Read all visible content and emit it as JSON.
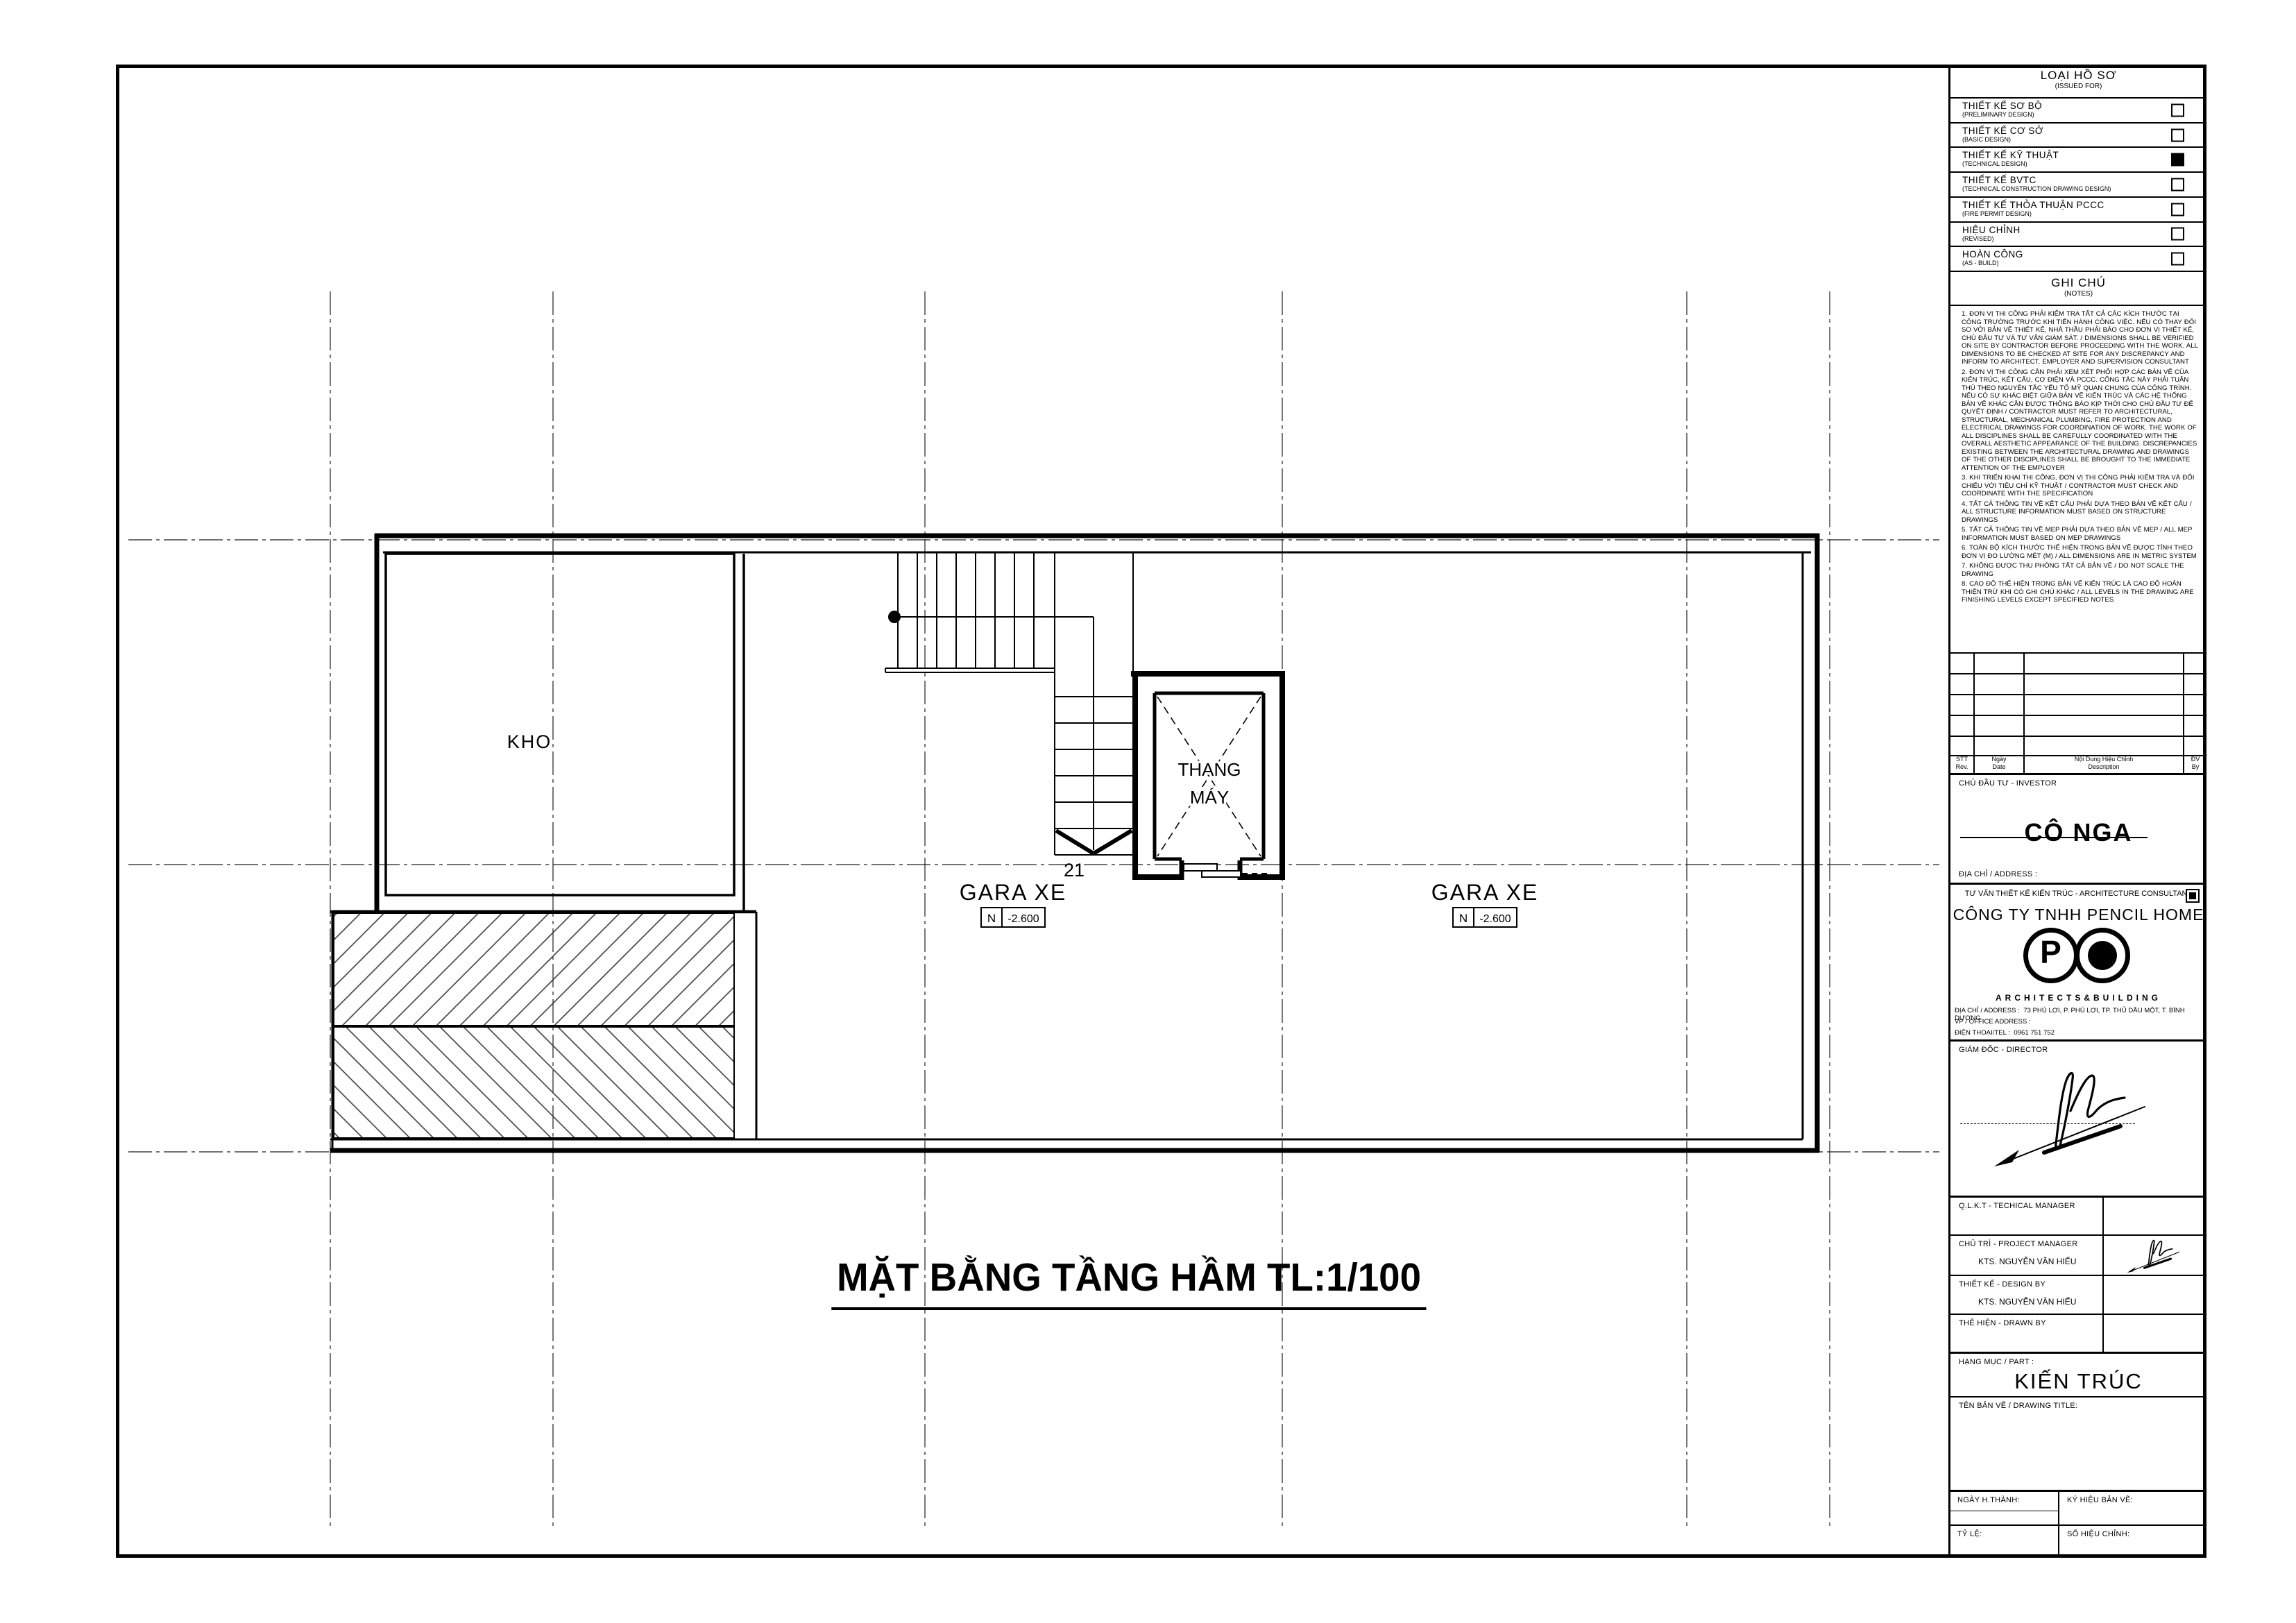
{
  "sheet": {
    "main_title": "MẶT BẰNG TẦNG HẦM  TL:1/100"
  },
  "issued_for": {
    "title": "LOẠI HỒ SƠ",
    "subtitle": "(ISSUED FOR)",
    "items": [
      {
        "vi": "THIẾT KẾ SƠ BỘ",
        "en": "(PRELIMINARY DESIGN)",
        "checked": false
      },
      {
        "vi": "THIẾT KẾ CƠ SỞ",
        "en": "(BASIC DESIGN)",
        "checked": false
      },
      {
        "vi": "THIẾT KẾ KỸ THUẬT",
        "en": "(TECHNICAL DESIGN)",
        "checked": true
      },
      {
        "vi": "THIẾT KẾ BVTC",
        "en": "(TECHNICAL CONSTRUCTION DRAWING DESIGN)",
        "checked": false
      },
      {
        "vi": "THIẾT KẾ THỎA THUẬN PCCC",
        "en": "(FIRE PERMIT DESIGN)",
        "checked": false
      },
      {
        "vi": "HIỆU CHỈNH",
        "en": "(REVISED)",
        "checked": false
      },
      {
        "vi": "HOÀN CÔNG",
        "en": "(AS - BUILD)",
        "checked": false
      }
    ]
  },
  "notes": {
    "title": "GHI CHÚ",
    "subtitle": "(NOTES)",
    "items": [
      "1.    ĐƠN VỊ THI CÔNG PHẢI KIỂM TRA TẤT CẢ CÁC KÍCH THƯỚC TẠI CÔNG TRƯỜNG TRƯỚC KHI TIẾN HÀNH CÔNG VIỆC. NẾU CÓ THAY ĐỔI SO VỚI BẢN VẼ THIẾT KẾ, NHÀ THẦU PHẢI BÁO CHO ĐƠN VỊ THIẾT KẾ, CHỦ ĐẦU TƯ VÀ TƯ VẤN GIÁM SÁT. / DIMENSIONS SHALL BE VERIFIED ON SITE BY CONTRACTOR BEFORE PROCEEDING WITH THE WORK. ALL DIMENSIONS TO BE CHECKED AT SITE FOR ANY DISCREPANCY AND INFORM TO ARCHITECT, EMPLOYER AND SUPERVISION CONSULTANT",
      "2.    ĐƠN VỊ THI CÔNG CẦN PHẢI XEM XÉT PHỐI HỢP CÁC BẢN VẼ CỦA KIẾN TRÚC, KẾT CẤU, CƠ ĐIỆN VÀ PCCC. CÔNG TÁC NÀY PHẢI TUÂN THỦ THEO NGUYÊN TẮC YẾU TỐ MỸ QUAN CHUNG CỦA CÔNG TRÌNH. NẾU CÓ SỰ KHÁC BIỆT GIỮA BẢN VẼ KIẾN TRÚC VÀ CÁC HỆ THỐNG BẢN VẼ KHÁC CẦN ĐƯỢC THÔNG BÁO KỊP THỜI CHO CHỦ ĐẦU TƯ ĐỂ QUYẾT ĐỊNH / CONTRACTOR MUST REFER TO ARCHITECTURAL, STRUCTURAL, MECHANICAL PLUMBING, FIRE PROTECTION AND ELECTRICAL DRAWINGS FOR COORDINATION OF WORK. THE WORK OF ALL DISCIPLINES SHALL BE CAREFULLY COORDINATED WITH THE OVERALL AESTHETIC APPEARANCE OF THE BUILDING. DISCREPANCIES EXISTING BETWEEN THE ARCHITECTURAL DRAWING AND DRAWINGS OF THE OTHER DISCIPLINES SHALL BE BROUGHT TO THE IMMEDIATE ATTENTION OF THE EMPLOYER",
      "3.    KHI TRIỂN KHAI THI CÔNG, ĐƠN VỊ THI CÔNG PHẢI KIỂM TRA VÀ ĐỐI CHIẾU VỚI TIÊU CHÍ KỸ THUẬT / CONTRACTOR MUST CHECK AND COORDINATE WITH THE SPECIFICATION",
      "4.    TẤT CẢ THÔNG TIN VỀ KẾT CẤU PHẢI DỰA THEO BẢN VẼ KẾT CẤU / ALL STRUCTURE INFORMATION MUST BASED ON STRUCTURE DRAWINGS",
      "5.    TẤT CẢ THÔNG TIN VỀ MEP PHẢI DỰA THEO BẢN VẼ MEP / ALL MEP INFORMATION MUST BASED ON MEP DRAWINGS",
      "6.    TOÀN BỘ KÍCH THƯỚC THỂ HIỆN TRONG BẢN VẼ ĐƯỢC TÍNH THEO ĐƠN VỊ ĐO LƯỜNG MÉT (M) / ALL DIMENSIONS ARE IN METRIC SYSTEM",
      "7.    KHÔNG ĐƯỢC THU PHÓNG TẤT CẢ BẢN VẼ / DO NOT SCALE THE DRAWING",
      "8.    CAO ĐỘ THỂ HIỆN TRONG BẢN VẼ KIẾN TRÚC LÀ CAO ĐỘ HOÀN THIỆN TRỪ KHI CÓ GHI CHÚ KHÁC / ALL LEVELS IN THE DRAWING ARE FINISHING LEVELS EXCEPT SPECIFIED NOTES"
    ]
  },
  "revisions": {
    "headers": {
      "stt_vi": "STT",
      "stt_en": "Rev.",
      "date_vi": "Ngày",
      "date_en": "Date",
      "desc_vi": "Nội Dung Hiệu Chỉnh",
      "desc_en": "Description",
      "by_vi": "ĐV",
      "by_en": "By"
    }
  },
  "investor": {
    "label": "CHỦ ĐẦU TƯ - INVESTOR",
    "name": "CÔ NGA",
    "address_label": "ĐỊA CHỈ / ADDRESS :"
  },
  "consultant": {
    "label": "TƯ VẤN THIẾT KẾ KIẾN TRÚC - ARCHITECTURE CONSULTANT",
    "company": "CÔNG TY TNHH PENCIL HOME",
    "logo_letter": "P",
    "logo_tagline": "ARCHITECTS&BUILDING",
    "address_label": "ĐỊA CHỈ / ADDRESS :",
    "address": "73 PHÚ LỢI, P. PHÚ LỢI, TP. THỦ DẦU MỘT, T. BÌNH DƯƠNG",
    "office_label": "VP / OFFICE ADDRESS :",
    "tel_label": "ĐIỆN THOẠI/TEL   :",
    "tel": "0961 751 752"
  },
  "signers": {
    "director_label": "GIÁM ĐỐC - DIRECTOR",
    "technical_label": "Q.L.K.T - TECHICAL MANAGER",
    "pm_label": "CHỦ TRÌ - PROJECT MANAGER",
    "pm_name": "KTS. NGUYỄN VĂN HIẾU",
    "design_label": "THIẾT KẾ - DESIGN BY",
    "design_name": "KTS. NGUYỄN VĂN HIẾU",
    "drawn_label": "THỂ HIỆN - DRAWN BY"
  },
  "part": {
    "label": "HẠNG MỤC / PART :",
    "value": "KIẾN TRÚC"
  },
  "drawing_title": {
    "label": "TÊN BẢN VẼ / DRAWING TITLE:"
  },
  "footer": {
    "date_label": "NGÀY H.THÀNH:",
    "symbol_label": "KÝ HIỆU BẢN VẼ:",
    "scale_label": "TỶ LỆ:",
    "revision_label": "SỐ HIỆU CHỈNH:"
  },
  "plan": {
    "kho": "KHO",
    "elevator_line1": "THANG",
    "elevator_line2": "MÁY",
    "gara_label": "GARA XE",
    "level_datum": "N",
    "level_value": "-2.600",
    "stair_number": "21"
  }
}
